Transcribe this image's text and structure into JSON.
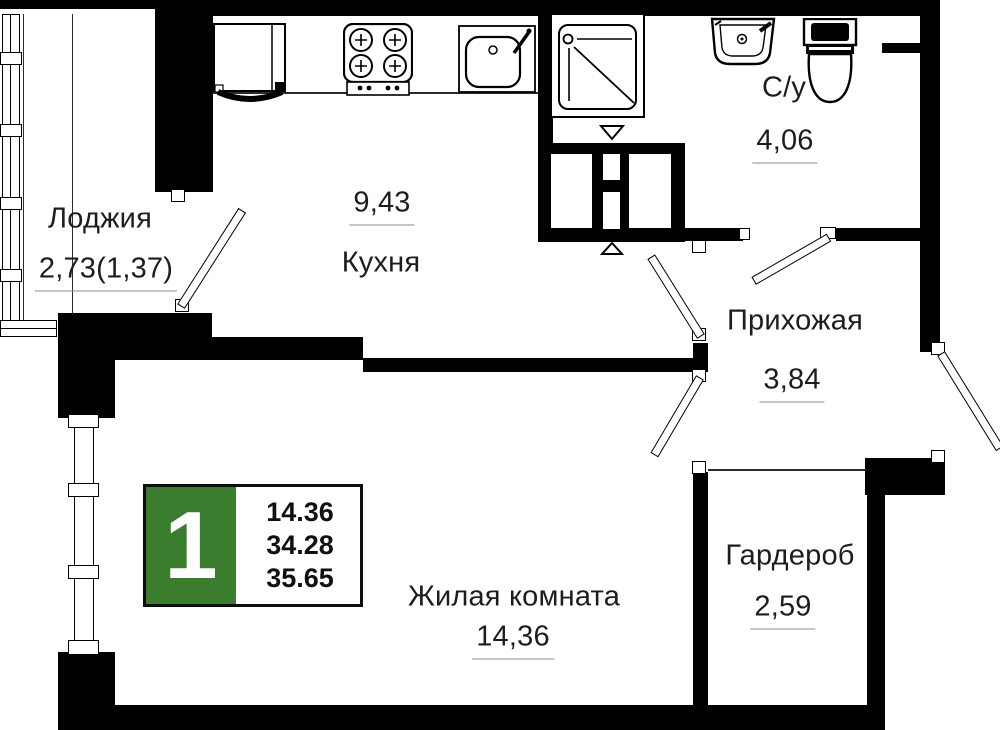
{
  "badge": {
    "flat_number": "1",
    "areas": [
      "14.36",
      "34.28",
      "35.65"
    ],
    "accent_color": "#3b7d2e"
  },
  "rooms": {
    "loggia": {
      "name": "Лоджия",
      "area": "2,73(1,37)"
    },
    "kitchen": {
      "name": "Кухня",
      "area": "9,43"
    },
    "bathroom": {
      "name": "С/у",
      "area": "4,06"
    },
    "hallway": {
      "name": "Прихожая",
      "area": "3,84"
    },
    "living": {
      "name": "Жилая комната",
      "area": "14,36"
    },
    "wardrobe": {
      "name": "Гардероб",
      "area": "2,59"
    }
  },
  "icons": {
    "fixtures": [
      "fridge-icon",
      "stove-icon",
      "kitchen-sink-icon",
      "shower-icon",
      "washbasin-icon",
      "toilet-icon",
      "vent-shaft-icon",
      "vent-arrow-down-icon",
      "vent-arrow-up-icon",
      "door-leaf-icon",
      "window-icon"
    ]
  }
}
